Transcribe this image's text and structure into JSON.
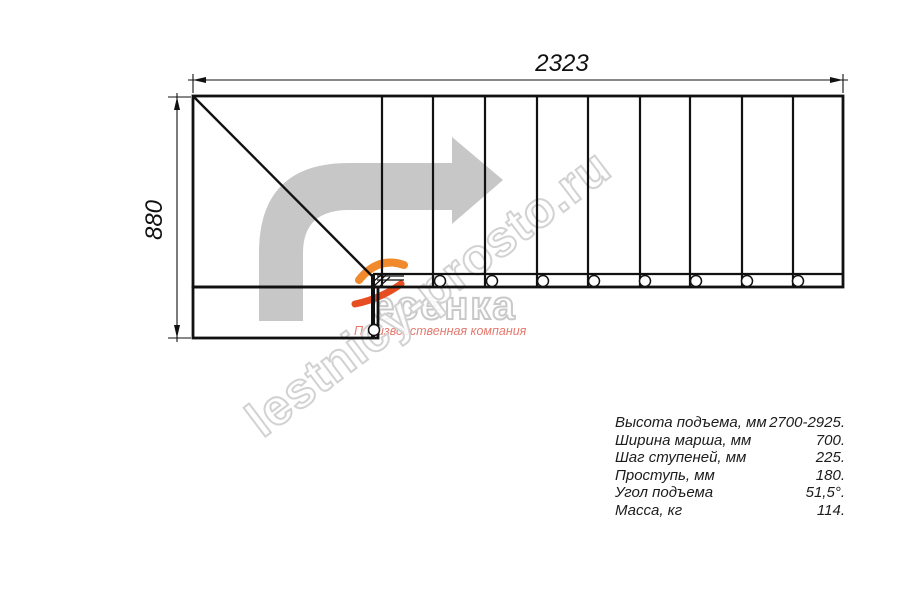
{
  "watermark": {
    "site_text": "lestnicy-prosto.ru",
    "brand_name": "есенка",
    "brand_full_name": "Лесенка",
    "brand_subtitle": "Производственная компания",
    "arrow_color": "#c7c7c7",
    "outline_color": "#d2d2d2",
    "subtitle_color": "#e5796e",
    "flame_color_top": "#f08a2c",
    "flame_color_bottom": "#e64e22"
  },
  "drawing": {
    "title": "Staircase plan view",
    "width_label": "2323",
    "height_label": "880",
    "line_color": "#111111",
    "main_rect": {
      "x": 193,
      "y": 96,
      "w": 650,
      "h": 191
    },
    "landing_rect": {
      "x": 193,
      "y": 287,
      "w": 185,
      "h": 51
    },
    "strip": {
      "y": 274,
      "x0": 373,
      "x1": 843
    },
    "winder_edge": {
      "x": 373,
      "y0": 274,
      "y1": 338
    },
    "diagonal": {
      "x1": 194,
      "y1": 97,
      "x2": 372,
      "y2": 276
    },
    "step_xs": [
      382,
      433,
      485,
      537,
      588,
      640,
      690,
      742,
      793
    ],
    "step_y0": 96,
    "step_y1": 287,
    "circle_xs": [
      440,
      492,
      543,
      594,
      645,
      696,
      747,
      798
    ],
    "circle_y": 281,
    "circle_r": 5.5,
    "landing_circle": {
      "x": 374,
      "y": 330,
      "r": 5.5
    },
    "dim_top": {
      "y": 80,
      "x0": 193,
      "x1": 843,
      "label_x": 562,
      "label_y": 71
    },
    "dim_left": {
      "x": 177,
      "y0": 97,
      "y1": 338,
      "label_x": 162,
      "label_y": 220
    }
  },
  "specs": {
    "rows": [
      {
        "label": "Высота подъема, мм",
        "value": "2700-2925."
      },
      {
        "label": "Ширина марша, мм",
        "value": "700."
      },
      {
        "label": "Шаг ступеней, мм",
        "value": "225."
      },
      {
        "label": "Проступь, мм",
        "value": "180."
      },
      {
        "label": "Угол подъема",
        "value": "51,5°."
      },
      {
        "label": "Масса, кг",
        "value": "114."
      }
    ]
  }
}
